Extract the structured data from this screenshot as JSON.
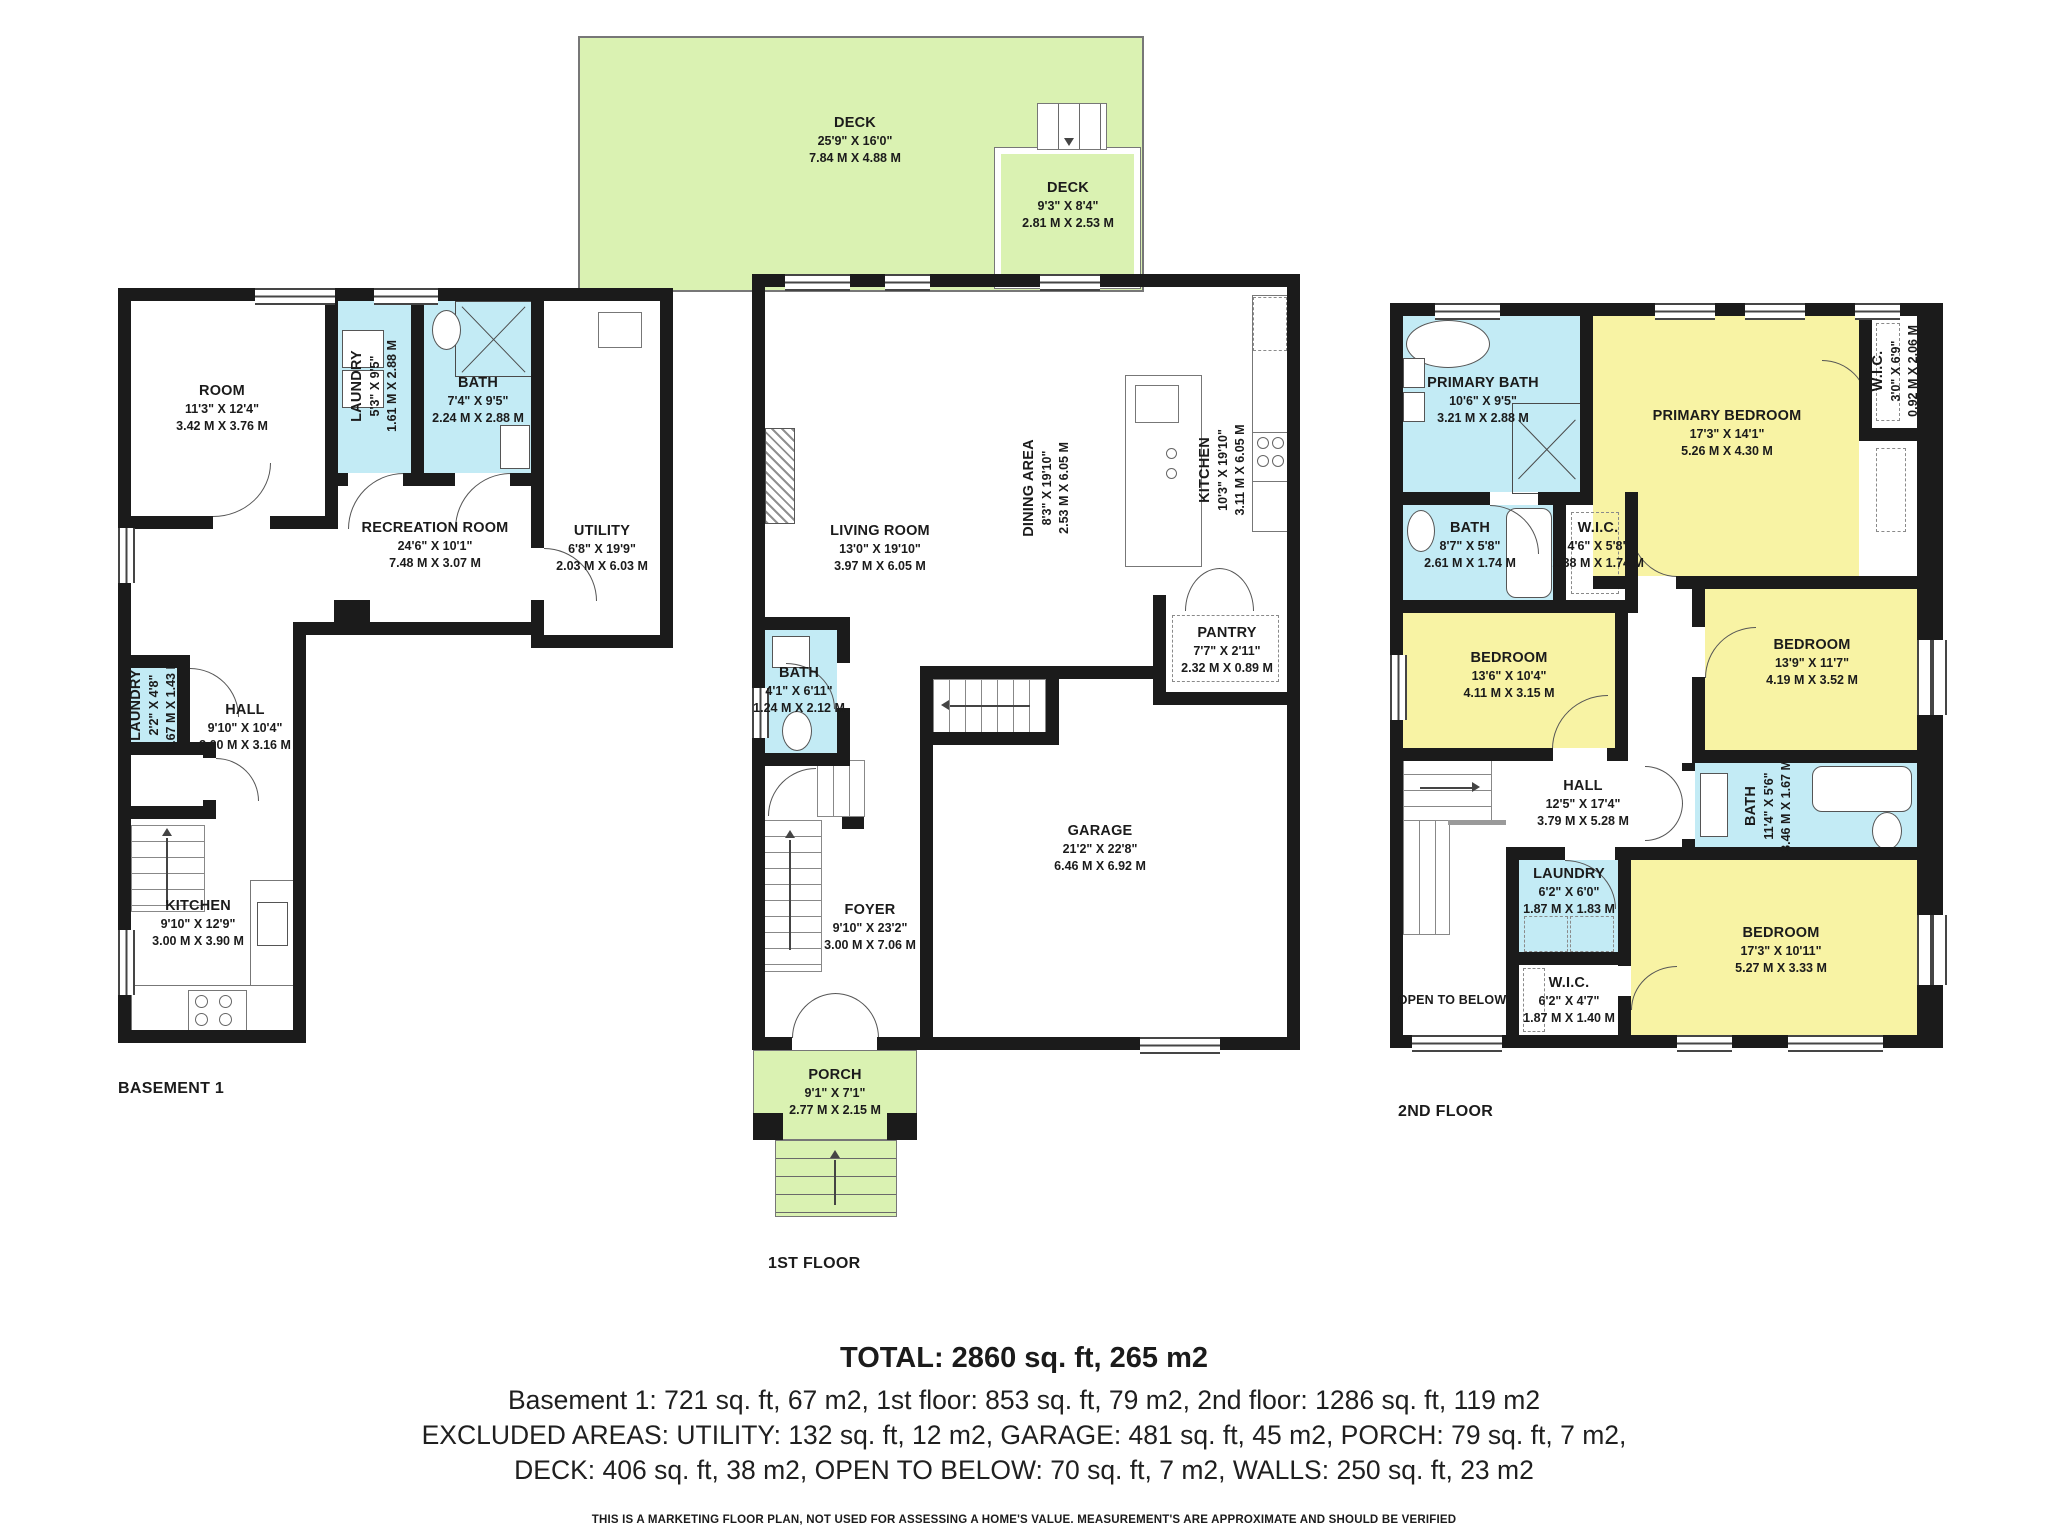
{
  "colors": {
    "wall": "#1b1b1b",
    "wet_room_blue": "#c3ebf5",
    "bedroom_yellow": "#f8f3a4",
    "outdoor_green": "#daf2b2",
    "background": "#ffffff"
  },
  "floors": {
    "basement": {
      "label": "BASEMENT 1",
      "rooms": [
        {
          "name": "ROOM",
          "imperial": "11'3\" X 12'4\"",
          "metric": "3.42 M X 3.76 M"
        },
        {
          "name": "LAUNDRY",
          "imperial": "5'3\" X 9'5\"",
          "metric": "1.61 M X 2.88 M"
        },
        {
          "name": "BATH",
          "imperial": "7'4\" X 9'5\"",
          "metric": "2.24 M X 2.88 M"
        },
        {
          "name": "UTILITY",
          "imperial": "6'8\" X 19'9\"",
          "metric": "2.03 M X 6.03 M"
        },
        {
          "name": "RECREATION ROOM",
          "imperial": "24'6\" X 10'1\"",
          "metric": "7.48 M X 3.07 M"
        },
        {
          "name": "LAUNDRY",
          "imperial": "2'2\" X 4'8\"",
          "metric": "0.67 M X 1.43 M"
        },
        {
          "name": "HALL",
          "imperial": "9'10\" X 10'4\"",
          "metric": "3.00 M X 3.16 M"
        },
        {
          "name": "KITCHEN",
          "imperial": "9'10\" X 12'9\"",
          "metric": "3.00 M X 3.90 M"
        }
      ]
    },
    "first": {
      "label": "1ST FLOOR",
      "rooms": [
        {
          "name": "DECK",
          "imperial": "25'9\" X 16'0\"",
          "metric": "7.84 M X 4.88 M"
        },
        {
          "name": "DECK",
          "imperial": "9'3\" X 8'4\"",
          "metric": "2.81 M X 2.53 M"
        },
        {
          "name": "LIVING ROOM",
          "imperial": "13'0\" X 19'10\"",
          "metric": "3.97 M X 6.05 M"
        },
        {
          "name": "DINING AREA",
          "imperial": "8'3\" X 19'10\"",
          "metric": "2.53 M X 6.05 M"
        },
        {
          "name": "KITCHEN",
          "imperial": "10'3\" X 19'10\"",
          "metric": "3.11 M X 6.05 M"
        },
        {
          "name": "PANTRY",
          "imperial": "7'7\" X 2'11\"",
          "metric": "2.32 M X 0.89 M"
        },
        {
          "name": "BATH",
          "imperial": "4'1\" X 6'11\"",
          "metric": "1.24 M X 2.12 M"
        },
        {
          "name": "FOYER",
          "imperial": "9'10\" X 23'2\"",
          "metric": "3.00 M X 7.06 M"
        },
        {
          "name": "GARAGE",
          "imperial": "21'2\" X 22'8\"",
          "metric": "6.46 M X 6.92 M"
        },
        {
          "name": "PORCH",
          "imperial": "9'1\" X 7'1\"",
          "metric": "2.77 M X 2.15 M"
        }
      ]
    },
    "second": {
      "label": "2ND FLOOR",
      "rooms": [
        {
          "name": "PRIMARY BATH",
          "imperial": "10'6\" X 9'5\"",
          "metric": "3.21 M X 2.88 M"
        },
        {
          "name": "PRIMARY BEDROOM",
          "imperial": "17'3\" X 14'1\"",
          "metric": "5.26 M X 4.30 M"
        },
        {
          "name": "W.I.C.",
          "imperial": "3'0\" X 6'9\"",
          "metric": "0.92 M X 2.06 M"
        },
        {
          "name": "BATH",
          "imperial": "8'7\" X 5'8\"",
          "metric": "2.61 M X 1.74 M"
        },
        {
          "name": "W.I.C.",
          "imperial": "4'6\" X 5'8\"",
          "metric": "1.38 M X 1.74 M"
        },
        {
          "name": "BEDROOM",
          "imperial": "13'6\" X 10'4\"",
          "metric": "4.11 M X 3.15 M"
        },
        {
          "name": "BEDROOM",
          "imperial": "13'9\" X 11'7\"",
          "metric": "4.19 M X 3.52 M"
        },
        {
          "name": "HALL",
          "imperial": "12'5\" X 17'4\"",
          "metric": "3.79 M X 5.28 M"
        },
        {
          "name": "BATH",
          "imperial": "11'4\" X 5'6\"",
          "metric": "3.46 M X 1.67 M"
        },
        {
          "name": "LAUNDRY",
          "imperial": "6'2\" X 6'0\"",
          "metric": "1.87 M X 1.83 M"
        },
        {
          "name": "W.I.C.",
          "imperial": "6'2\" X 4'7\"",
          "metric": "1.87 M X 1.40 M"
        },
        {
          "name": "BEDROOM",
          "imperial": "17'3\" X 10'11\"",
          "metric": "5.27 M X 3.33 M"
        },
        {
          "name": "OPEN TO BELOW",
          "imperial": "",
          "metric": ""
        }
      ]
    }
  },
  "summary": {
    "total": "TOTAL: 2860 sq. ft, 265 m2",
    "line2": "Basement 1: 721 sq. ft, 67 m2, 1st floor: 853 sq. ft, 79 m2, 2nd floor: 1286 sq. ft, 119 m2",
    "line3": "EXCLUDED AREAS: UTILITY: 132 sq. ft, 12 m2, GARAGE: 481 sq. ft, 45 m2, PORCH: 79 sq. ft, 7 m2,",
    "line4": "DECK: 406 sq. ft, 38 m2, OPEN TO BELOW: 70 sq. ft, 7 m2, WALLS: 250 sq. ft, 23 m2",
    "disclaimer": "THIS IS A MARKETING FLOOR PLAN, NOT USED FOR ASSESSING A HOME'S VALUE. MEASUREMENT'S ARE APPROXIMATE AND SHOULD BE VERIFIED"
  }
}
